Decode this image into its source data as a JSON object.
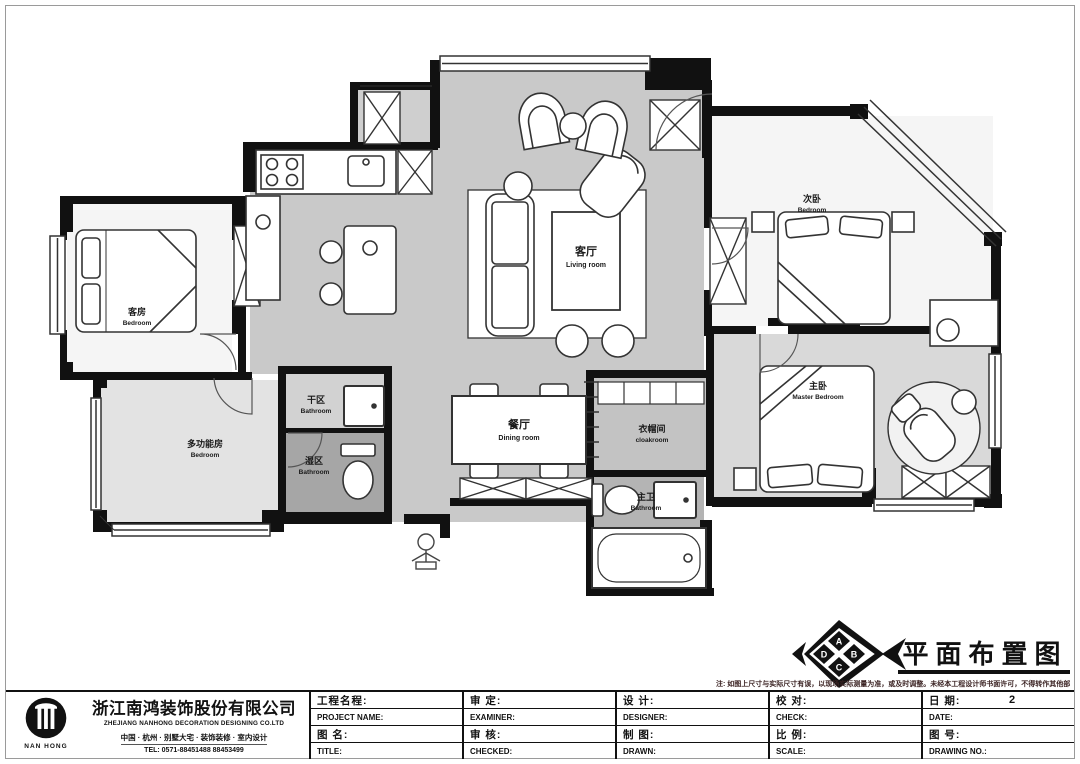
{
  "sheet": {
    "drawing_title": "平面布置图",
    "note": "注: 如图上尺寸与实际尺寸有误，以现场实际测量为准，或及时调整。未经本工程设计师书面许可，不得转作其他部分使用。",
    "compass": [
      "A",
      "B",
      "C",
      "D"
    ]
  },
  "company": {
    "logo_text": "NAN HONG",
    "name_cn": "浙江南鸿装饰股份有限公司",
    "name_en": "ZHEJIANG NANHONG DECORATION DESIGNING CO.LTD",
    "services": "中国 · 杭州 · 别墅大宅 · 装饰装修 · 室内设计",
    "tel": "TEL:  0571-88451488  88453499"
  },
  "title_block": {
    "cells": [
      {
        "r1_cn": "工程名程:",
        "r1_en": "PROJECT NAME:",
        "r2_cn": "图 名:",
        "r2_en": "TITLE:"
      },
      {
        "r1_cn": "审  定:",
        "r1_en": "EXAMINER:",
        "r2_cn": "审  核:",
        "r2_en": "CHECKED:"
      },
      {
        "r1_cn": "设  计:",
        "r1_en": "DESIGNER:",
        "r2_cn": "制  图:",
        "r2_en": "DRAWN:"
      },
      {
        "r1_cn": "校  对:",
        "r1_en": "CHECK:",
        "r2_cn": "比  例:",
        "r2_en": "SCALE:"
      },
      {
        "r1_cn": "日  期:",
        "r1_value": "2",
        "r1_en": "DATE:",
        "r2_cn": "图  号:",
        "r2_en": "DRAWING NO.:"
      }
    ]
  },
  "rooms": {
    "living": {
      "cn": "客厅",
      "en": "Living room"
    },
    "dining": {
      "cn": "餐厅",
      "en": "Dining room"
    },
    "guest": {
      "cn": "客房",
      "en": "Bedroom"
    },
    "multi": {
      "cn": "多功能房",
      "en": "Bedroom"
    },
    "dry": {
      "cn": "干区",
      "en": "Bathroom"
    },
    "wet": {
      "cn": "湿区",
      "en": "Bathroom"
    },
    "bed2": {
      "cn": "次卧",
      "en": "Bedroom"
    },
    "master": {
      "cn": "主卧",
      "en": "Master Bedroom"
    },
    "cloak": {
      "cn": "衣帽间",
      "en": "cloakroom"
    },
    "mbath": {
      "cn": "主卫",
      "en": "Bathroom"
    }
  },
  "colors": {
    "wall": "#111111",
    "floor": "#c9c9c9",
    "floor_dark": "#a6a6a6",
    "line": "#333333"
  }
}
